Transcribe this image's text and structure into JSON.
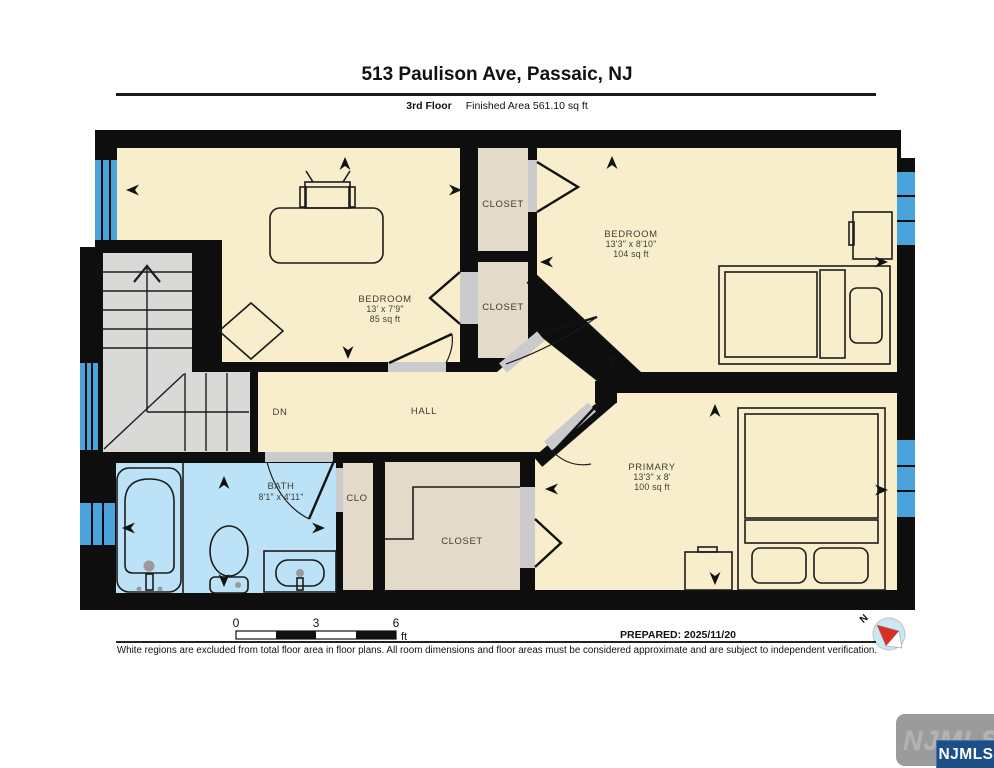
{
  "header": {
    "title": "513 Paulison Ave, Passaic, NJ",
    "floor_label": "3rd Floor",
    "area_label": "Finished Area 561.10 sq ft"
  },
  "rooms": {
    "bedroom_left": {
      "name": "BEDROOM",
      "dims": "13' x 7'9\"",
      "area": "85 sq ft"
    },
    "bedroom_right": {
      "name": "BEDROOM",
      "dims": "13'3\" x 8'10\"",
      "area": "104 sq ft"
    },
    "primary": {
      "name": "PRIMARY",
      "dims": "13'3\" x 8'",
      "area": "100 sq ft"
    },
    "bath": {
      "name": "BATH",
      "dims": "8'1\" x 4'11\""
    },
    "hall": {
      "name": "HALL"
    },
    "stairs_dn": {
      "label": "DN"
    },
    "closet_small": {
      "name": "CLO"
    },
    "closet_top": {
      "name": "CLOSET"
    },
    "closet_mid": {
      "name": "CLOSET"
    },
    "closet_bottom": {
      "name": "CLOSET"
    }
  },
  "scale_bar": {
    "t0": "0",
    "t1": "3",
    "t2": "6",
    "unit": "ft"
  },
  "footer": {
    "prepared": "PREPARED: 2025/11/20",
    "disclaimer": "White regions are excluded from total floor area in floor plans. All room dimensions and floor areas must be considered approximate and are subject to independent verification."
  },
  "compass": {
    "north_label": "N"
  },
  "branding": {
    "watermark": "NJMLS",
    "badge": "NJMLS"
  },
  "colors": {
    "wall": "#0e0e0e",
    "room": "#F8EECB",
    "closet": "#E3DACA",
    "stairs": "#D9D9D7",
    "bath": "#BCE2F7",
    "window": "#4BA3DB",
    "doorgap": "#CBCBCE",
    "label": "#3E3E35",
    "badge": "#1B4F86",
    "watermark": "#9B9B9B"
  }
}
